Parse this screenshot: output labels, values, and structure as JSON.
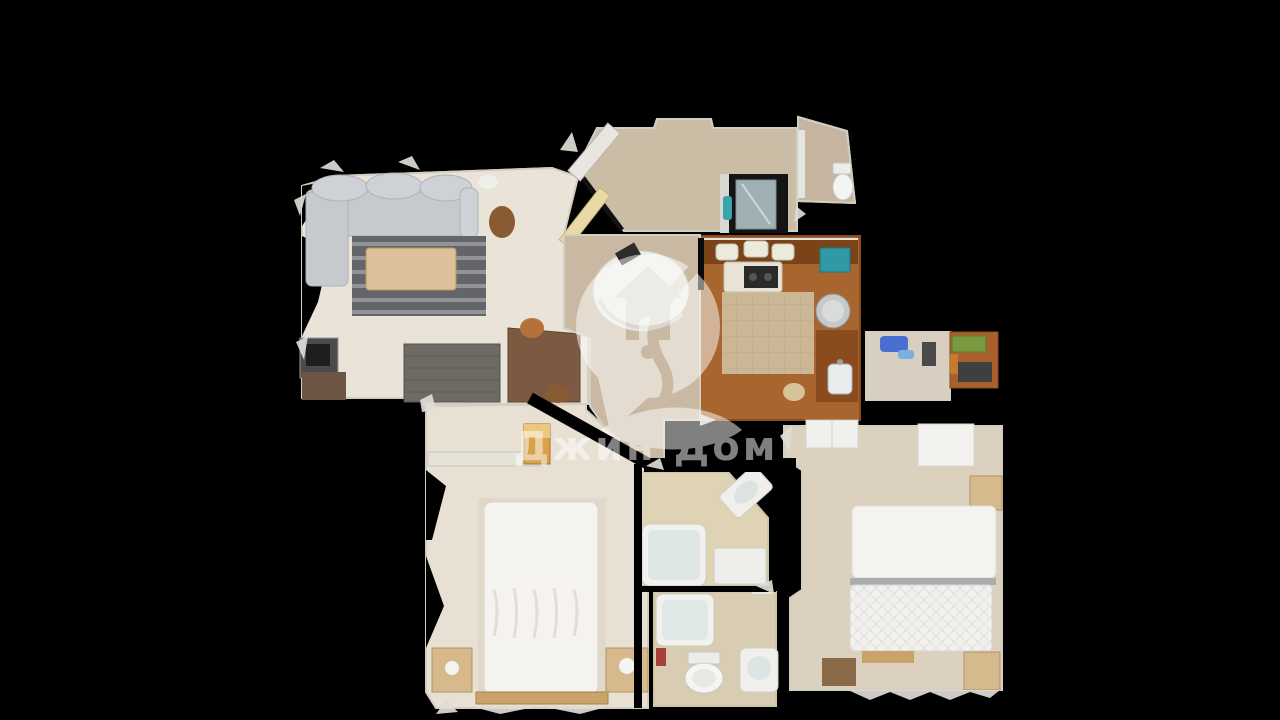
{
  "background_color": "#000000",
  "watermark": {
    "brand_text": "Джин Дом",
    "logo_name": "house-pin-leaf-logo",
    "color": "#ffffff",
    "opacity": "0.5"
  },
  "palette": {
    "floor_living": "#e9e3d8",
    "floor_hall": "#c9b9a2",
    "floor_corridor": "#cbbca6",
    "floor_wc": "#c5b5a0",
    "floor_kitchen_wood": "#a8662e",
    "floor_kitchen_center": "#cbb796",
    "floor_bath_upper": "#ded3b2",
    "floor_bath_lower": "#d8cdb2",
    "floor_bedroom_left": "#e7e0d3",
    "floor_bedroom_right": "#dcd1bf",
    "floor_storage": "#d9cfc0",
    "sofa_gray": "#c6cacf",
    "rug_dark": "#64656a",
    "coffee_table_wood": "#dcc09a",
    "wood_furniture": "#d6b98c",
    "dark_table": "#6e6a64",
    "desk_brown": "#7c5a42",
    "cabinet_brown": "#7a4418",
    "mattress_white": "#f4f3f0",
    "fixture_white": "#f2f2f0",
    "glass_shower": "#b9ccd1",
    "accent_teal": "#2f9aa6",
    "accent_blue": "#4a6fd0",
    "accent_green": "#7a9a3f",
    "wall_cut_light": "#dedcd6"
  },
  "scene": {
    "description": "top-down 3D dollhouse scan of an apartment floor plan on black background",
    "rooms": [
      "living-room",
      "entry-corridor",
      "wc",
      "shower-room",
      "kitchen",
      "hallway",
      "storage-room",
      "bedroom-left",
      "bathroom-upper",
      "bathroom-lower",
      "bedroom-right"
    ]
  }
}
